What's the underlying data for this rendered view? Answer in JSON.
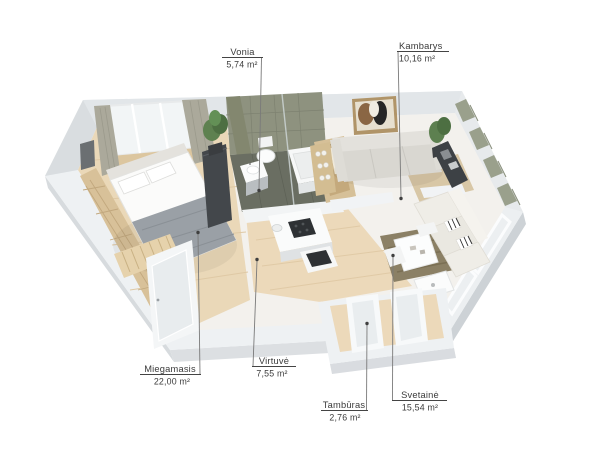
{
  "labels": [
    {
      "name": "Vonia",
      "area": "5,74 m²"
    },
    {
      "name": "Kambarys",
      "area": "10,16 m²"
    },
    {
      "name": "Miegamasis",
      "area": "22,00 m²"
    },
    {
      "name": "Virtuvė",
      "area": "7,55 m²"
    },
    {
      "name": "Tambūras",
      "area": "2,76 m²"
    },
    {
      "name": "Svetainė",
      "area": "15,54 m²"
    }
  ],
  "colors": {
    "background": "#ffffff",
    "wall_top": "#eef1f3",
    "wall_shade": "#d7dbde",
    "floor_wood": "#ead8b8",
    "floor_light": "#f3f1ed",
    "bathroom_tile": "#8e927f",
    "bathroom_floor": "#6a6e62",
    "curtain_green": "#9aa08c",
    "curtain_taupe": "#aba99b",
    "rug_beige": "#d8c7a6",
    "rug_olive": "#8b8065",
    "dark_furniture": "#3d4145",
    "label_text": "#3a3a3a",
    "leader_line": "#7a7a7a"
  }
}
